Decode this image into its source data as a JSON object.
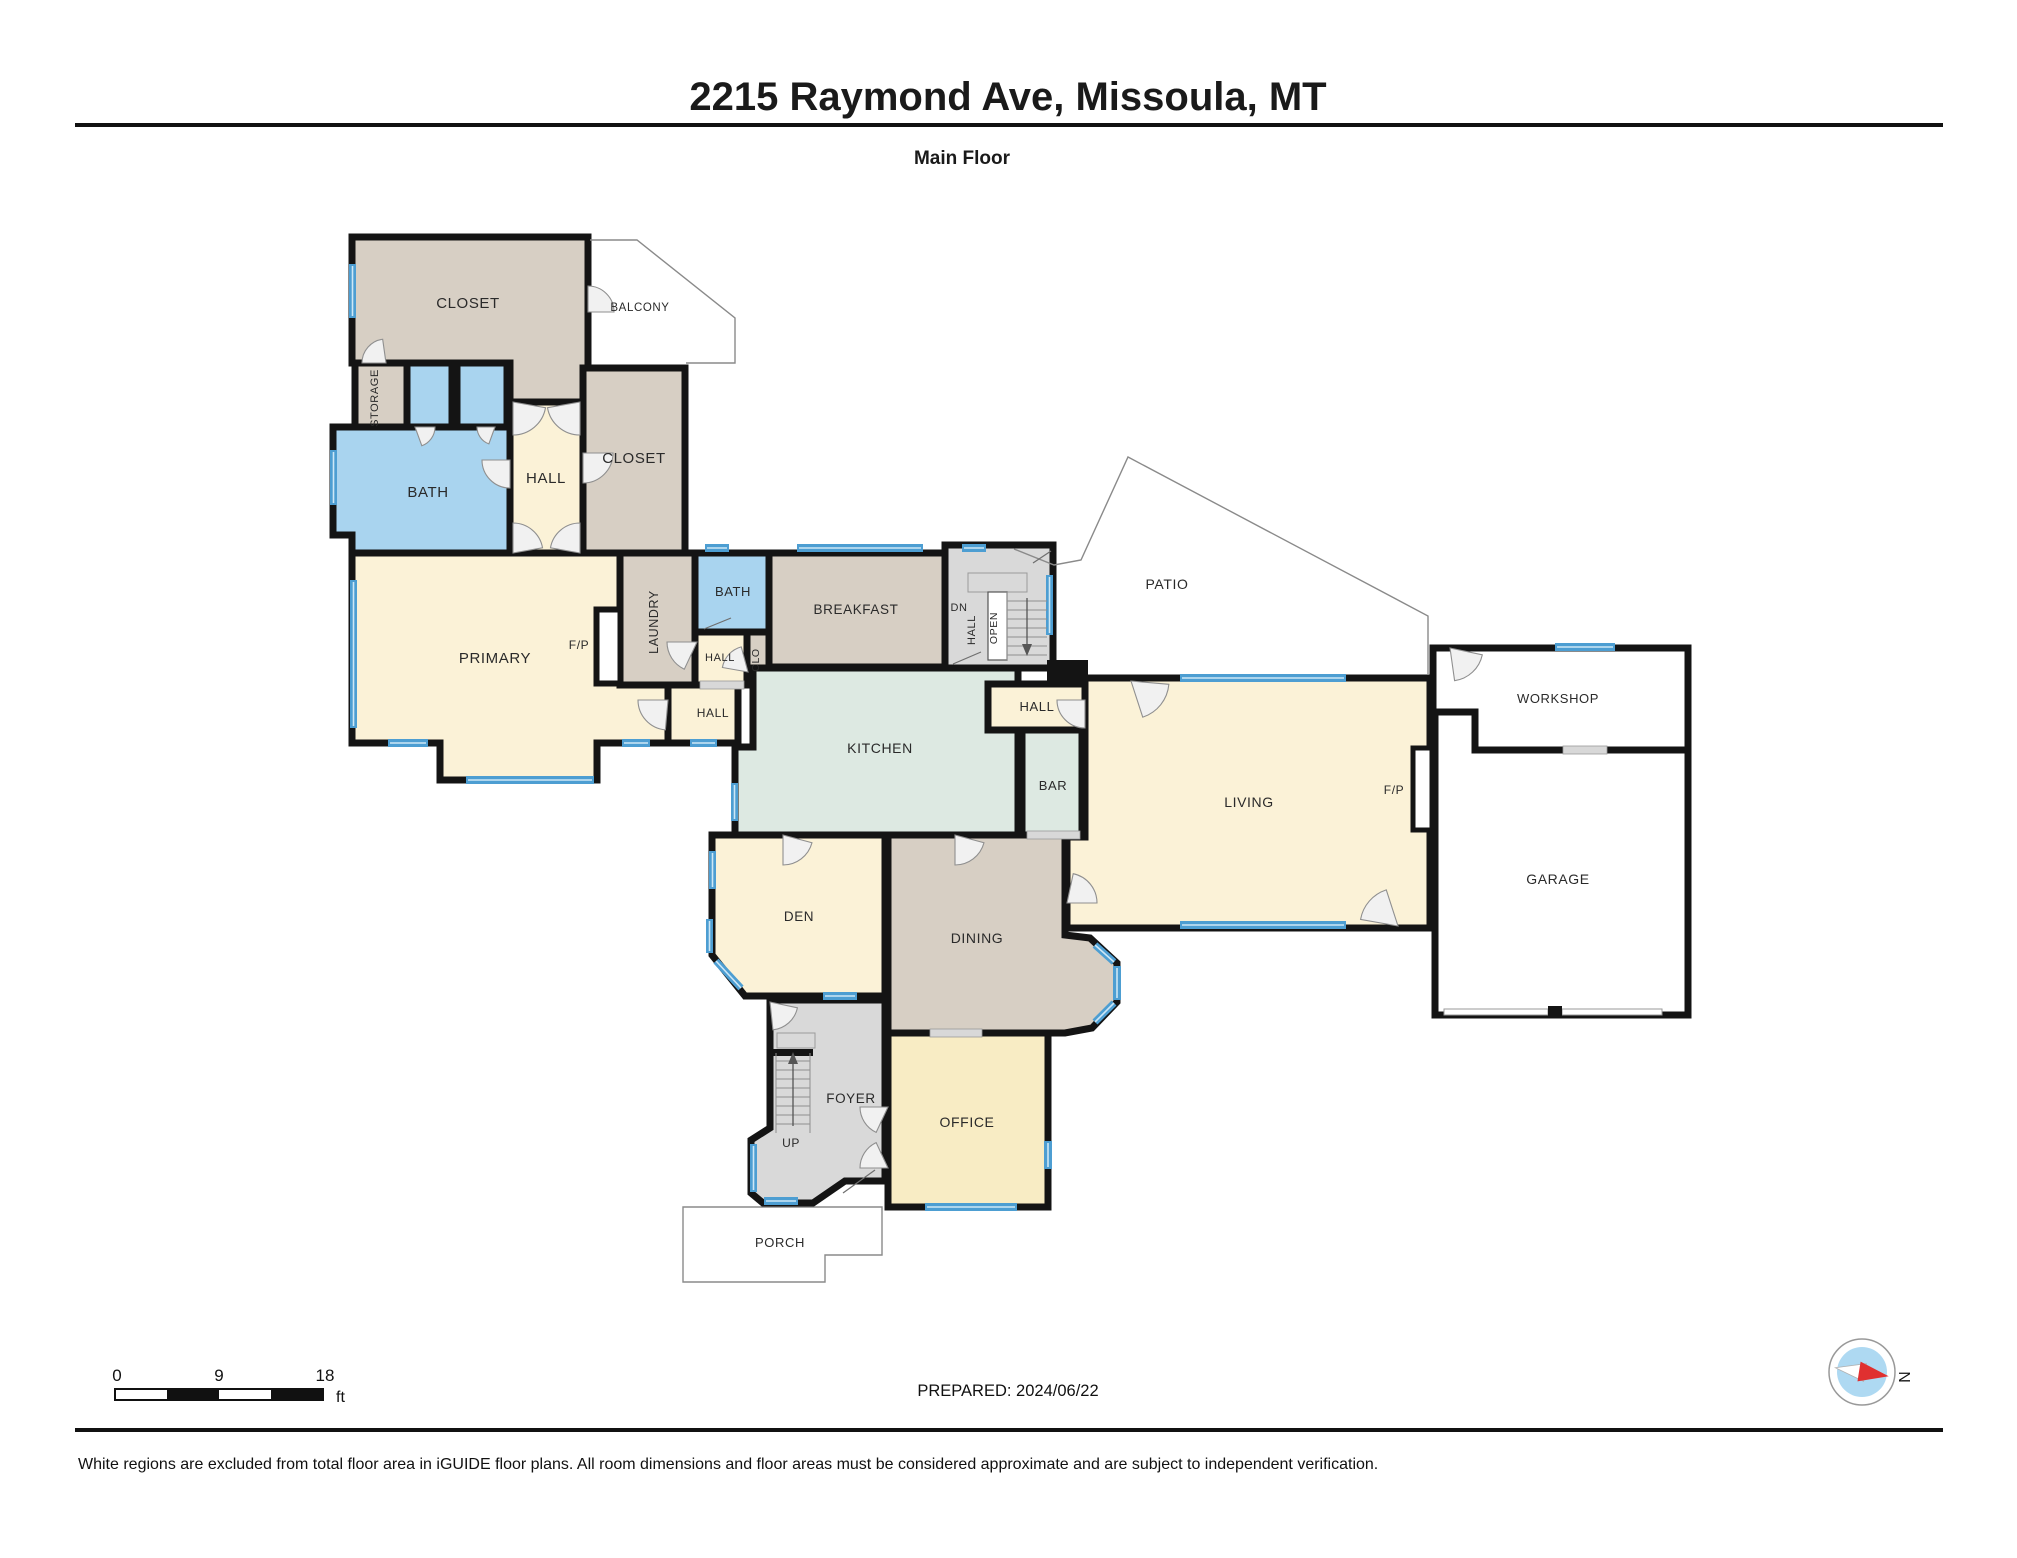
{
  "header": {
    "title": "2215 Raymond Ave, Missoula, MT",
    "subtitle": "Main Floor"
  },
  "floor_plan": {
    "rooms": [
      {
        "id": "closet-upper",
        "label": "CLOSET"
      },
      {
        "id": "balcony",
        "label": "BALCONY"
      },
      {
        "id": "storage",
        "label": "STORAGE"
      },
      {
        "id": "bath-upper",
        "label": "BATH"
      },
      {
        "id": "hall-upper",
        "label": "HALL"
      },
      {
        "id": "closet-hall",
        "label": "CLOSET"
      },
      {
        "id": "primary",
        "label": "PRIMARY"
      },
      {
        "id": "fireplace-primary",
        "label": "F/P"
      },
      {
        "id": "laundry",
        "label": "LAUNDRY"
      },
      {
        "id": "bath-main",
        "label": "BATH"
      },
      {
        "id": "hall-bath",
        "label": "HALL"
      },
      {
        "id": "clo",
        "label": "CLO"
      },
      {
        "id": "hall-center",
        "label": "HALL"
      },
      {
        "id": "breakfast",
        "label": "BREAKFAST"
      },
      {
        "id": "stairs-down",
        "label": "DN"
      },
      {
        "id": "hall-stairs",
        "label": "HALL"
      },
      {
        "id": "stairs-open",
        "label": "OPEN"
      },
      {
        "id": "patio",
        "label": "PATIO"
      },
      {
        "id": "hall-living",
        "label": "HALL"
      },
      {
        "id": "kitchen",
        "label": "KITCHEN"
      },
      {
        "id": "bar",
        "label": "BAR"
      },
      {
        "id": "living",
        "label": "LIVING"
      },
      {
        "id": "fireplace-living",
        "label": "F/P"
      },
      {
        "id": "workshop",
        "label": "WORKSHOP"
      },
      {
        "id": "garage",
        "label": "GARAGE"
      },
      {
        "id": "den",
        "label": "DEN"
      },
      {
        "id": "dining",
        "label": "DINING"
      },
      {
        "id": "foyer",
        "label": "FOYER"
      },
      {
        "id": "stairs-up",
        "label": "UP"
      },
      {
        "id": "office",
        "label": "OFFICE"
      },
      {
        "id": "porch",
        "label": "PORCH"
      }
    ]
  },
  "scale_bar": {
    "tick_start": "0",
    "tick_mid": "9",
    "tick_end": "18",
    "unit": "ft"
  },
  "prepared_label": "PREPARED: 2024/06/22",
  "compass": {
    "north_label": "N"
  },
  "footer": {
    "disclaimer": "White regions are excluded from total floor area in iGUIDE floor plans. All room dimensions and floor areas must be considered approximate and are subject to independent verification."
  },
  "colors": {
    "wall": "#141414",
    "window": "#4d9ed2",
    "room_tan": "#d7cfc4",
    "room_cream": "#fbf2d7",
    "room_yellow": "#f8ecc4",
    "room_blue": "#a9d4ef",
    "room_mint": "#dde9e2",
    "room_gray": "#d9d9d9",
    "compass_inner": "#aed9f2",
    "compass_needle": "#e03030"
  }
}
